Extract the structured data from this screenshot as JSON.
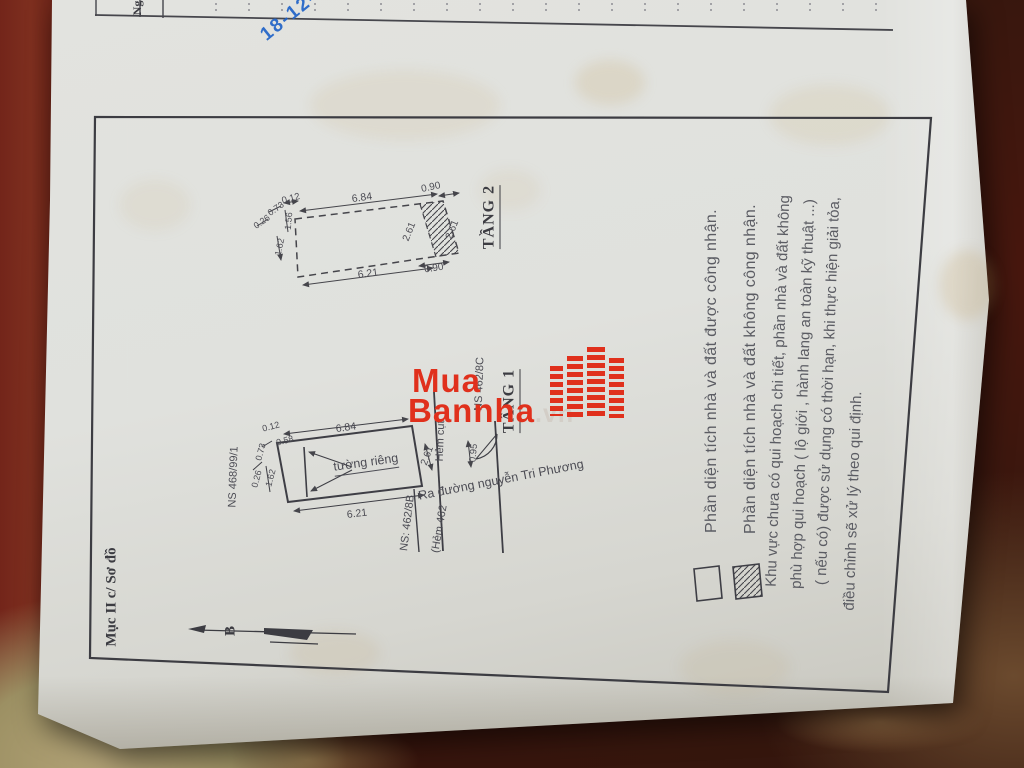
{
  "stamp": {
    "date": "18-12-"
  },
  "table": {
    "col_label": "Ng"
  },
  "watermark": {
    "word1": "Mua",
    "word2": "Bannha",
    "tld": ".vn"
  },
  "section_label": "Mục II c/ Sơ đồ",
  "compass": {
    "label": "B"
  },
  "floor2": {
    "title": "TẦNG 2",
    "dims": {
      "d012": "0.12",
      "d684": "6.84",
      "d090t": "0.90",
      "d261a": "2.61",
      "d261b": "2.61",
      "d090b": "0.90",
      "d621": "6.21",
      "d073": "0.73",
      "d026": "0.26",
      "d156": "1.56",
      "d162": "1.62"
    }
  },
  "floor1": {
    "title": "TẦNG 1",
    "wall": "tường riêng",
    "dims": {
      "d684": "6.84",
      "d621": "6.21",
      "d261": "2.61",
      "d095": "0.95",
      "d012": "0.12",
      "d058": "0.58",
      "d073": "0.73",
      "d026": "0.26",
      "d162": "1.62"
    },
    "labels": {
      "alley_dead_end": "Hẻm cụt",
      "street": "Ra đường nguyễn Tri Phương",
      "alley": "(Hẻm 462",
      "ns_8b": "NS: 462/8B",
      "ns_8c": "NS 462/8C",
      "ns_99": "NS 468/99/1"
    }
  },
  "legend": {
    "recognized": "Phần diện tích nhà và đất được công nhận.",
    "not_recognized": "Phần diện tích nhà và đất không công nhận."
  },
  "note": {
    "line1": "Khu vực chưa có qui hoạch chi tiết, phần nhà và đất không",
    "line2": "phù hợp qui hoạch ( lộ giới , hành lang an toàn kỹ thuật ...)",
    "line3": "( nếu có) được sử dụng có thời hạn, khi thực hiện giải tỏa,",
    "line4": "điều chỉnh sẽ xử lý theo qui định."
  }
}
